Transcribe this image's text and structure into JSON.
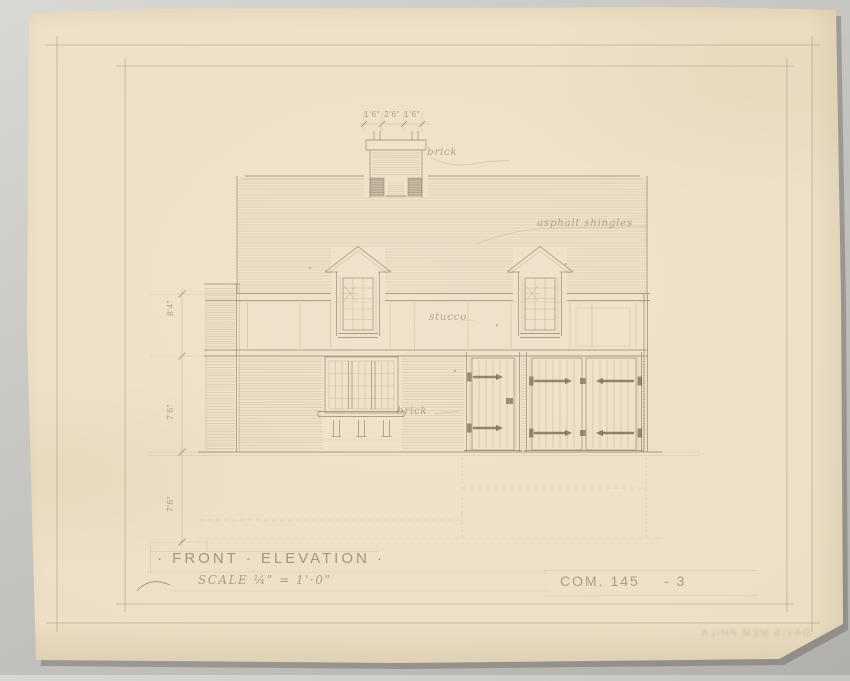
{
  "titleblock": {
    "title": "· FRONT · ELEVATION ·",
    "scale": "SCALE ¼\" = 1'·0\"",
    "drawing_number": "COM. 145",
    "sheet_number": "- 3",
    "faint_note": "DAVIS MEM PHILA"
  },
  "labels": {
    "chimney": "brick",
    "roof": "asphalt shingles",
    "wall": "stucco",
    "base": "brick"
  },
  "dims": {
    "chimney_left": "1'6\"",
    "chimney_mid": "2'6\"",
    "chimney_right": "1'6\"",
    "upper_height": "8'4\"",
    "lower_height": "7'6\"",
    "basement_height": "7'6\""
  }
}
